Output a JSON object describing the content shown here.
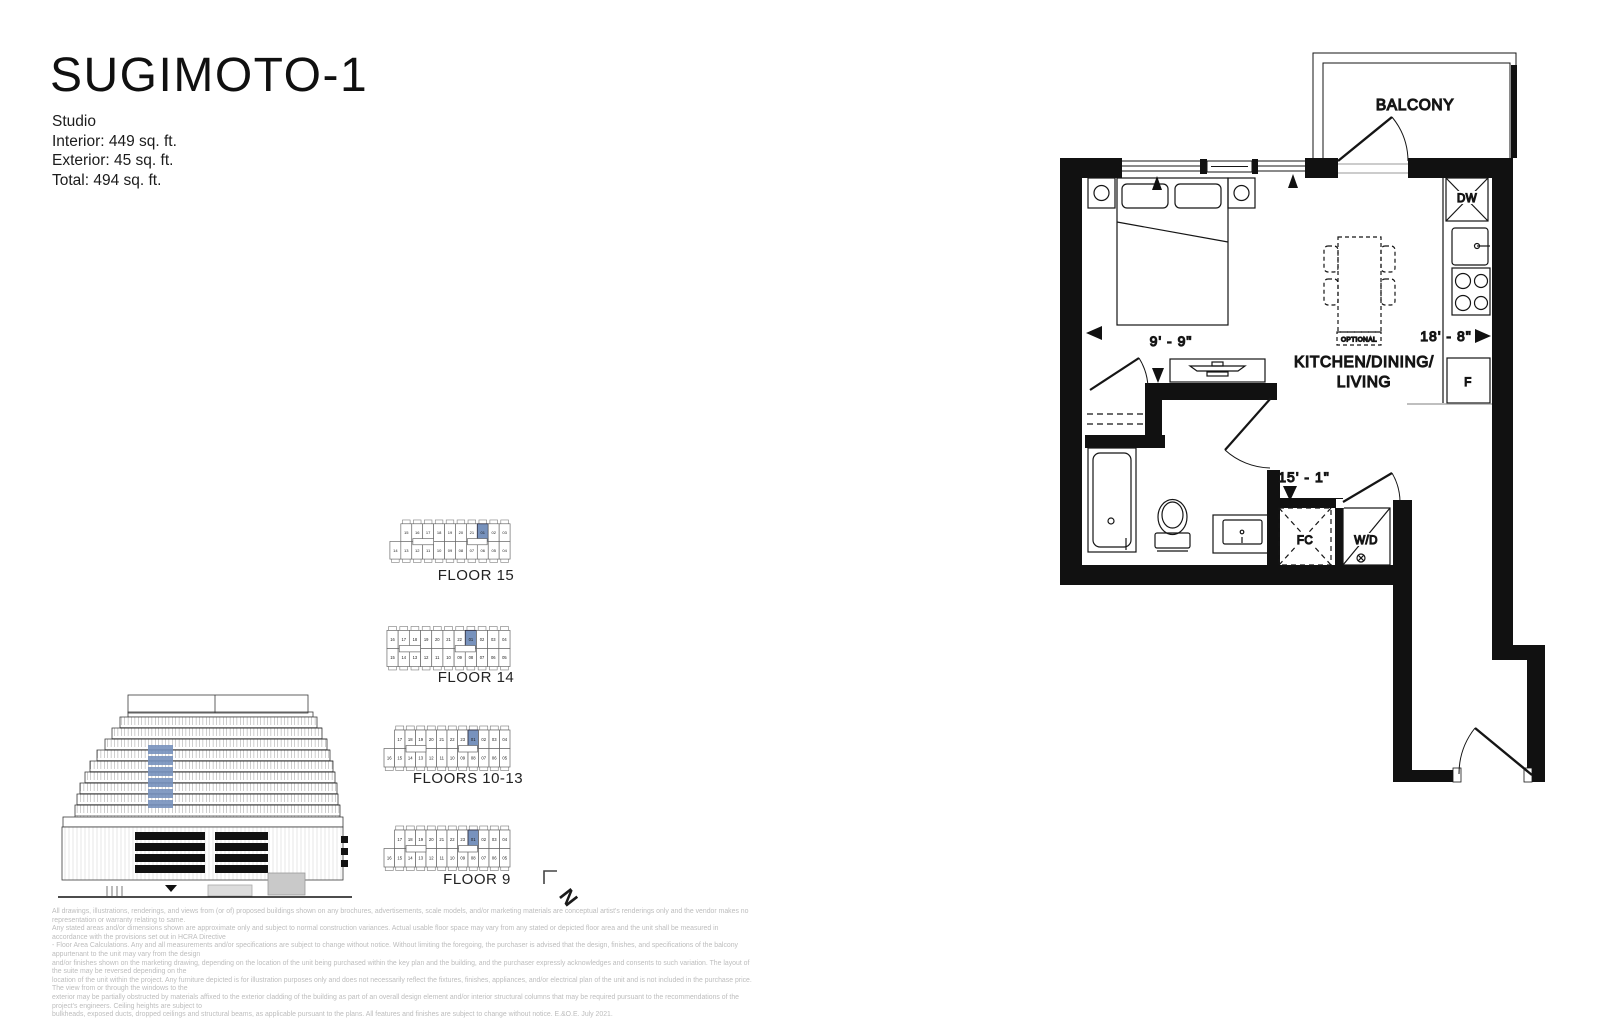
{
  "header": {
    "title": "SUGIMOTO-1",
    "unit_type": "Studio",
    "stats": [
      "Interior: 449 sq. ft.",
      "Exterior: 45 sq. ft.",
      "Total: 494 sq. ft."
    ]
  },
  "floor_plan": {
    "room_labels": {
      "balcony": "BALCONY",
      "kitchen_line1": "KITCHEN/DINING/",
      "kitchen_line2": "LIVING"
    },
    "fixture_labels": {
      "dishwasher": "DW",
      "fridge": "F",
      "fan_coil": "FC",
      "washer_dryer": "W/D",
      "optional_table": "OPTIONAL"
    },
    "dimensions": {
      "sleeping_width": "9' - 9\"",
      "living_length": "18' - 8\"",
      "hall_length": "15' - 1\""
    }
  },
  "key_plans": {
    "highlight_unit": "01",
    "highlight_color": "#7792bd",
    "floors": [
      {
        "label": "FLOOR 15",
        "top": [
          "15",
          "16",
          "17",
          "18",
          "19",
          "20",
          "21",
          "01",
          "02",
          "03"
        ],
        "bottom": [
          "14",
          "13",
          "12",
          "11",
          "10",
          "09",
          "08",
          "07",
          "06",
          "05",
          "04"
        ]
      },
      {
        "label": "FLOOR 14",
        "top": [
          "16",
          "17",
          "18",
          "19",
          "20",
          "21",
          "22",
          "01",
          "02",
          "03",
          "04"
        ],
        "bottom": [
          "15",
          "14",
          "13",
          "12",
          "11",
          "10",
          "09",
          "08",
          "07",
          "06",
          "05"
        ]
      },
      {
        "label": "FLOORS 10-13",
        "top": [
          "17",
          "18",
          "19",
          "20",
          "21",
          "22",
          "23",
          "01",
          "02",
          "03",
          "04"
        ],
        "bottom": [
          "16",
          "15",
          "14",
          "13",
          "12",
          "11",
          "10",
          "09",
          "08",
          "07",
          "06",
          "05"
        ]
      },
      {
        "label": "FLOOR 9",
        "top": [
          "17",
          "18",
          "19",
          "20",
          "21",
          "22",
          "23",
          "01",
          "02",
          "03",
          "04"
        ],
        "bottom": [
          "16",
          "15",
          "14",
          "13",
          "12",
          "11",
          "10",
          "09",
          "08",
          "07",
          "06",
          "05"
        ]
      }
    ]
  },
  "north_indicator": {
    "label": "N"
  },
  "disclaimer": {
    "lines": [
      "All drawings, illustrations, renderings, and views from (or of) proposed buildings shown on any brochures, advertisements, scale models, and/or marketing materials are conceptual artist's renderings only and the vendor makes no representation or warranty relating to same.",
      "Any stated areas and/or dimensions shown are approximate only and subject to normal construction variances. Actual usable floor space may vary from any stated or depicted floor area and the unit shall be measured in accordance with the provisions set out in HCRA Directive",
      "- Floor Area Calculations. Any and all measurements and/or specifications are subject to change without notice. Without limiting the foregoing, the purchaser is advised that the design, finishes, and specifications of the balcony appurtenant to the unit may vary from the design",
      "and/or finishes shown on the marketing drawing, depending on the location of the unit being purchased within the key plan and the building, and the purchaser expressly acknowledges and consents to such variation. The layout of the suite may be reversed depending on the",
      "location of the unit within the project. Any furniture depicted is for illustration purposes only and does not necessarily reflect the fixtures, finishes, appliances, and/or electrical plan of the unit and is not included in the purchase price. The view from or through the windows to the",
      "exterior may be partially obstructed by materials affixed to the exterior cladding of the building as part of an overall design element and/or interior structural columns that may be required pursuant to the recommendations of the project's engineers. Ceiling heights are subject to",
      "bulkheads, exposed ducts, dropped ceilings and structural beams, as applicable pursuant to the plans. All features and finishes are subject to change without notice. E.&O.E. July 2021."
    ]
  }
}
